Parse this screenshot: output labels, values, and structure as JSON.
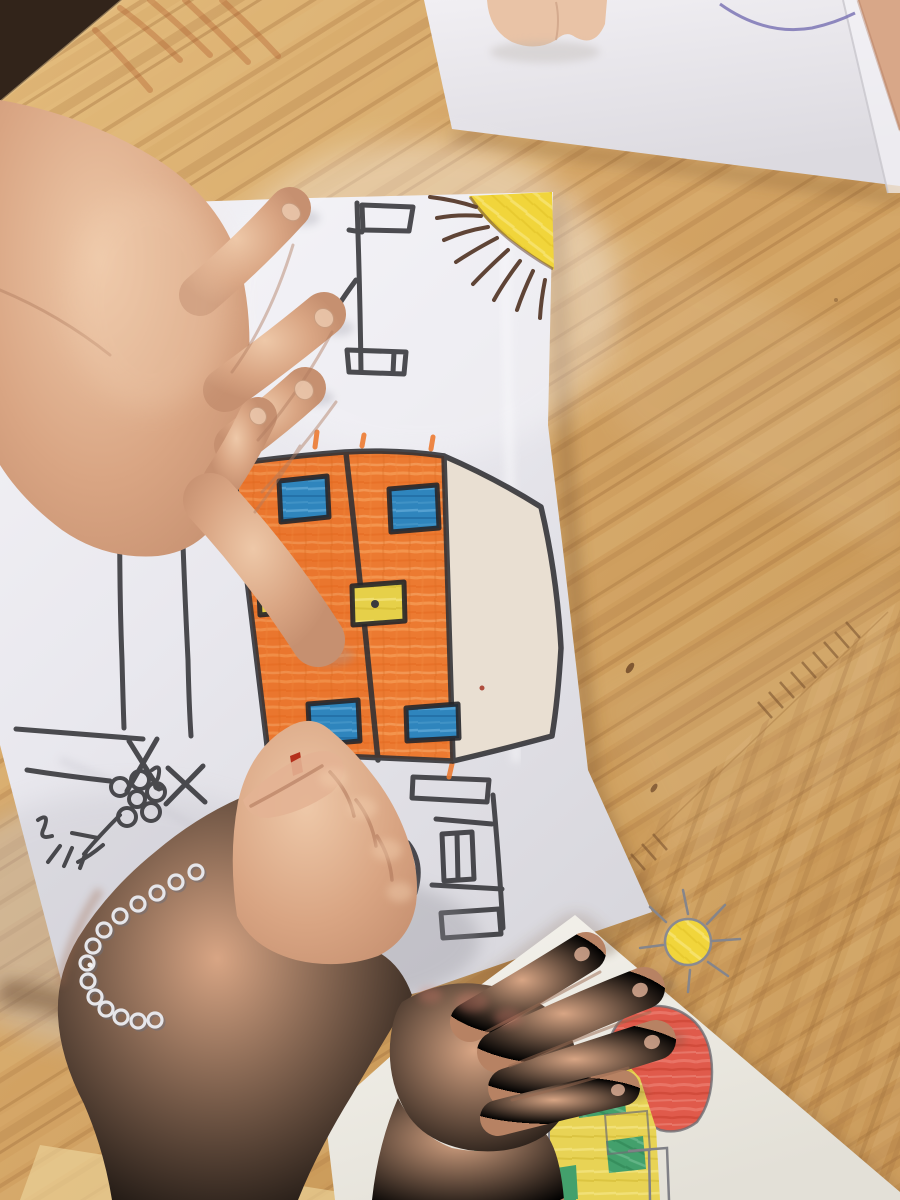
{
  "scene": {
    "description": "Photograph from above: children colouring hand-drawn crayon houses on white papers laid on a pale pine table. One child's hand colours an orange building with a small red crayon, a silver chain bracelet on the wrist; another child's hand rests on a second drawing of a red-domed house with a yellow sun.",
    "labels": {
      "wood_table": "pine table top",
      "background_paper": "blank paper at top with purple pen line",
      "knuckles": "fingertips of another child at top edge",
      "friend_skin": "arm of another child, top-right corner",
      "main_paper": "main drawing paper",
      "flag_sketch": "black crayon flag-post sketch",
      "left_building_sketch": "black crayon tower and flower sketch",
      "sun_main": "yellow corner sun with brown rays",
      "building": "orange two-panel building with blue and yellow windows",
      "door_ladder_sketch": "black crayon door and ladder sketch",
      "resting_hand": "child hand holding the paper",
      "coloring_hand": "child fist colouring with crayon",
      "crayon": "small red crayon",
      "bracelet": "silver chain bracelet",
      "second_paper": "second drawing paper",
      "second_drawing": "house with red dome, yellow wall, green windows, pencil sun",
      "second_hand": "second child's hand resting on drawing"
    }
  },
  "palette": {
    "wood_base": "#d6a968",
    "wood_grain_dark": "#a9763f",
    "wood_shadow": "#6e4826",
    "table_corner_dark": "#32241a",
    "paper_white": "#ebeaf0",
    "paper_beige": "#e9dfd2",
    "crayon_orange": "#ec7a31",
    "crayon_blue": "#2f85bd",
    "crayon_yellow": "#e6d049",
    "crayon_black": "#333337",
    "sun_yellow": "#f1d53b",
    "sun_ray_brown": "#5f4436",
    "pencil_gray": "#808086",
    "crayon_red": "#e05a4b",
    "wall_yellow": "#e8d355",
    "crayon_green": "#43a06c",
    "skin_light": "#e2b391",
    "skin_mid": "#d09a7a",
    "skin_dark": "#b07c60",
    "bracelet_silver": "#e6e6ea",
    "pen_purple": "#7d76b5",
    "crayon_tip_red": "#b5301c"
  }
}
